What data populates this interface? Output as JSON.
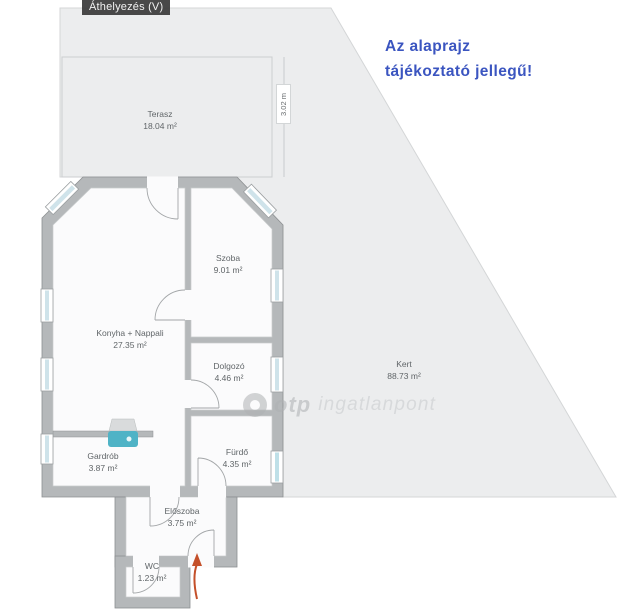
{
  "tooltip": {
    "label": "Áthelyezés (V)"
  },
  "disclaimer": {
    "line1": "Az alaprajz",
    "line2": "tájékoztató jellegű!"
  },
  "dimension": {
    "label": "3.02 m"
  },
  "rooms": [
    {
      "id": "terasz",
      "name": "Terasz",
      "area": "18.04 m²"
    },
    {
      "id": "szoba",
      "name": "Szoba",
      "area": "9.01 m²"
    },
    {
      "id": "konyha-nappali",
      "name": "Konyha + Nappali",
      "area": "27.35 m²"
    },
    {
      "id": "dolgozo",
      "name": "Dolgozó",
      "area": "4.46 m²"
    },
    {
      "id": "kert",
      "name": "Kert",
      "area": "88.73 m²"
    },
    {
      "id": "gardrob",
      "name": "Gardrób",
      "area": "3.87 m²"
    },
    {
      "id": "furdo",
      "name": "Fürdő",
      "area": "4.35 m²"
    },
    {
      "id": "eloszoba",
      "name": "Előszoba",
      "area": "3.75 m²"
    },
    {
      "id": "wc",
      "name": "WC",
      "area": "1.23 m²"
    }
  ],
  "watermark": {
    "brand": "otp",
    "suffix": "ingatlanpont"
  },
  "icons": {
    "sink": "sink-fixture-icon",
    "entrance": "entrance-arrow-icon",
    "logo": "otp-logo-ring-icon"
  },
  "colors": {
    "disclaimer_blue": "#3b55c0",
    "fixture_teal": "#4fb3c6",
    "entrance_arrow_orange": "#c4502a",
    "lot_gray": "#ecedee",
    "wall_gray": "#b5b8ba",
    "tooltip_bg": "#3a3a3a"
  }
}
